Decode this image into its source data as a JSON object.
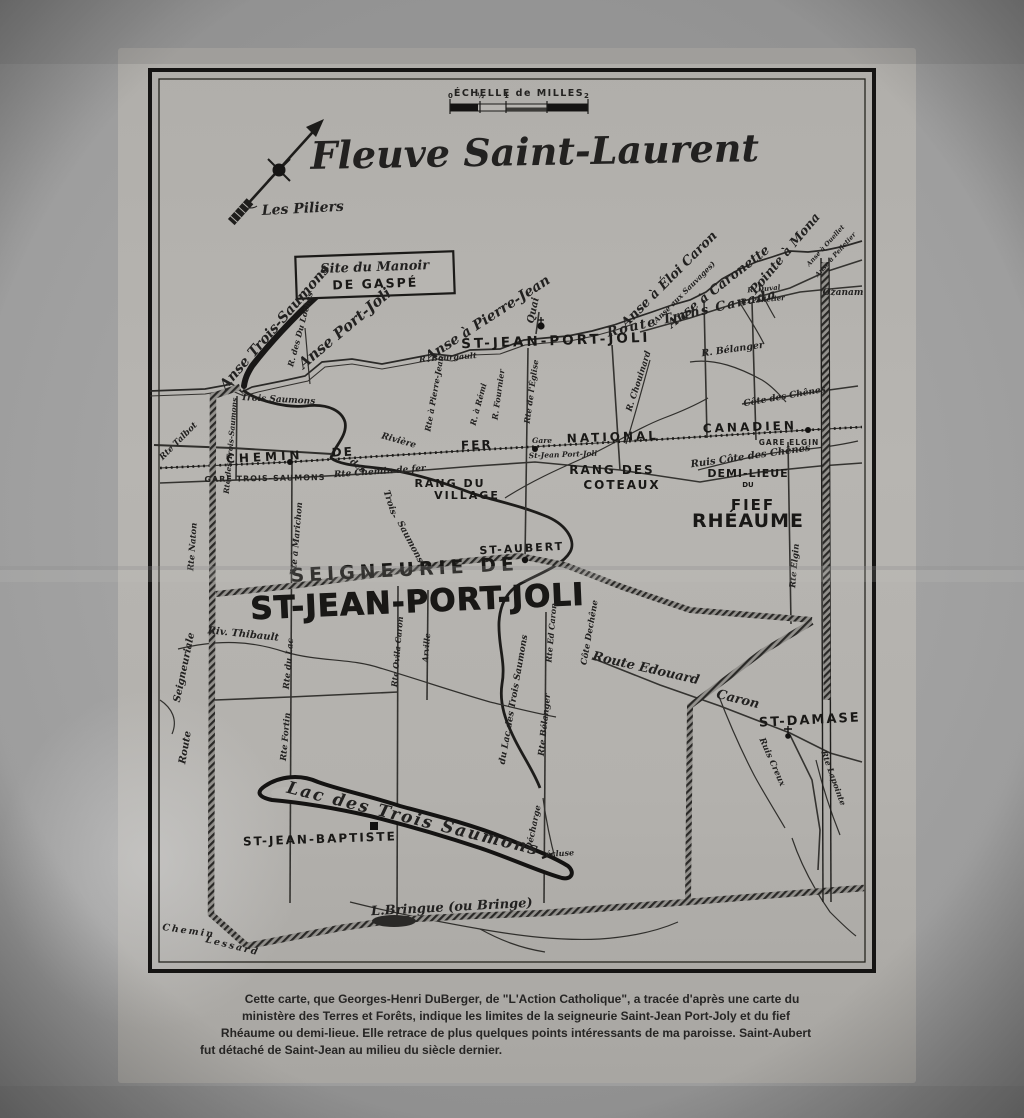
{
  "colors": {
    "paper": "#b4b2ae",
    "ink": "#1c1b19",
    "photo_bg": "#9a9a9a"
  },
  "scale_bar": {
    "title": "ÉCHELLE de MILLES",
    "ticks": [
      "0",
      "½",
      "1",
      "2"
    ]
  },
  "labels": {
    "title": "Fleuve Saint-Laurent",
    "les_piliers": "Les Piliers",
    "manoir_line1": "Site du Manoir",
    "manoir_line2": "DE GASPÉ",
    "anse_trois_saumons": "Anse Trois-Saumons",
    "anse_port_joli": "Anse Port-Joli",
    "r_des_du_loches": "R. des Du Loches",
    "anse_a_pierre_jean": "Anse à Pierre-Jean",
    "quai": "Quai",
    "st_jean_port_joli_village": "ST-JEAN-PORT-JOLI",
    "anse_a_eloi_caron": "Anse à Éloi Caron",
    "anse_aux_sauvages": "(Anse aux Sauvages)",
    "anse_a_caronette": "Anse à Caronette",
    "pointe_a_mona": "Pointe à Mona",
    "anse_a_ouellet": "Anse à Ouellet",
    "anse_a_pelletier": "Anse à Pelletier",
    "route_trans_canada": "Route Trans Canada",
    "r_duval": "R. Duval",
    "r_pelletier": "R. Pelletier",
    "ozanam": "Ozanam",
    "r_belanger": "R. Bélanger",
    "cote_des_chenes": "Côte des Chênes",
    "r_chouinard": "R. Chouinard",
    "rte_a_pierre_jean": "Rte à Pierre-Jean",
    "r_a_remi": "R. à Rémi",
    "r_fournier": "R. Fournier",
    "rte_de_leglise": "Rte de l'Église",
    "r_bourgault": "R. Bourgault",
    "chemin": "CHEMIN",
    "de": "DE",
    "fer": "FER",
    "national": "NATIONAL",
    "canadien": "CANADIEN",
    "gare_trois_saumons": "GARE TROIS-SAUMONS",
    "gare": "Gare",
    "gare_st_jean": "St-Jean Port-Joli",
    "gare_elgin": "GARE ELGIN",
    "rte_chemin_de_fer": "Rte Chemin de fer",
    "ruis_cote_des_chenes": "Ruis Côte des Chênes",
    "rang_du": "RANG DU",
    "village": "VILLAGE",
    "rang_des": "RANG DES",
    "coteaux": "COTEAUX",
    "demi_lieue": "DEMI-LIEUE",
    "du_fief": "DU",
    "fief": "FIEF",
    "rheaume": "RHÉAUME",
    "st_aubert": "ST-AUBERT",
    "seigneurie_de": "SEIGNEURIE DE",
    "st_jean_port_joli_big": "ST-JEAN-PORT-JOLI",
    "riviere_part": "Rivière",
    "des_part": "des",
    "trois_part": "Trois-",
    "saumons_part": "Saumons",
    "trois_saumons_mouth": "Trois Saumons",
    "rte_des_trois_saumons": "Rte des Trois-Saumons",
    "rte_talbot": "Rte Talbot",
    "rte_naton": "Rte Naton",
    "rte_a_marichon": "Rte à Marichon",
    "riv_thibault": "Riv. Thibault",
    "route_word": "Route",
    "seigneuriale_word": "Seigneuriale",
    "rte_du_lac": "Rte du Lac",
    "rte_fortin": "Rte Fortin",
    "rte_ovila_caron": "Rte Ovila Caron",
    "arville": "Arville",
    "du_lac_des_trois_saumons": "du Lac des Trois Saumons",
    "rte_belanger": "Rte Bélanger",
    "rte_ed_caron": "Rte Ed Caron",
    "cote_dechene": "Côte Dechêne",
    "route_edouard": "Route Edouard",
    "caron": "Caron",
    "st_damase": "ST-DAMASE",
    "ruis_creux": "Ruis Creux",
    "rte_lapointe": "Rte Lapointe",
    "rte_elgin": "Rte Elgin",
    "lac_des_trois_saumons": "Lac des Trois Saumons",
    "st_jean_baptiste": "ST-JEAN-BAPTISTE",
    "decharge": "Décharge",
    "ecluse": "écluse",
    "l_bringue": "L.Bringue (ou Bringe)",
    "chemin_lessard_1": "Chemin",
    "chemin_lessard_2": "Lessard"
  },
  "caption": {
    "lines": [
      "Cette carte, que Georges-Henri DuBerger, de \"L'Action Catholique\", a tracée d'après une carte du",
      "ministère des Terres et Forêts, indique les limites de la seigneurie Saint-Jean Port-Joly et du fief",
      "Rhéaume ou demi-lieue. Elle retrace de plus quelques points intéressants de ma paroisse. Saint-Aubert",
      "fut détaché de Saint-Jean au milieu du siècle dernier."
    ]
  }
}
